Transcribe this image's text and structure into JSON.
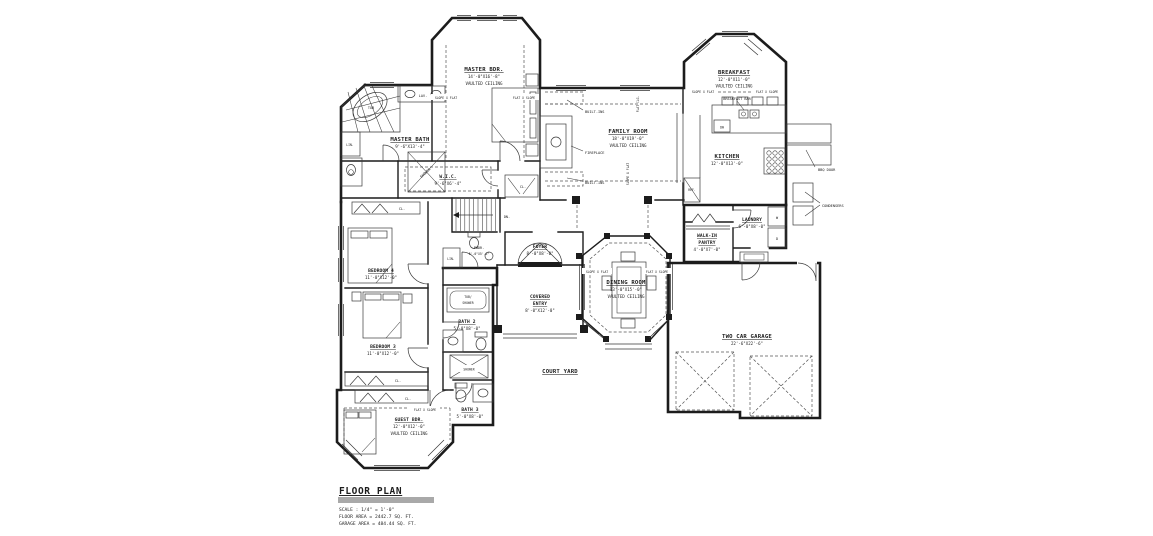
{
  "title_block": {
    "title": "FLOOR PLAN",
    "scale": "SCALE : 1/4\" = 1'-0\"",
    "floor_area": "FLOOR AREA = 2442.7 SQ. FT.",
    "garage_area": "GARAGE AREA = 484.44 SQ. FT."
  },
  "rooms": {
    "master_bdr": {
      "name": "MASTER BDR.",
      "dim": "14'-0\"X16'-8\"",
      "note": "VAULTED CEILING"
    },
    "master_bath": {
      "name": "MASTER BATH",
      "dim": "9'-6\"X13'-4\""
    },
    "wic": {
      "name": "W.I.C.",
      "dim": "9'-6\"X6'-4\""
    },
    "family_room": {
      "name": "FAMILY ROOM",
      "dim": "18'-0\"X19'-0\"",
      "note": "VAULTED CEILING"
    },
    "breakfast": {
      "name": "BREAKFAST",
      "dim": "12'-0\"X11'-0\"",
      "note": "VAULTED CEILING"
    },
    "kitchen": {
      "name": "KITCHEN",
      "dim": "12'-0\"X13'-0\""
    },
    "laundry": {
      "name": "LAUNDRY",
      "dim": "6'-0\"X8'-0\""
    },
    "pantry": {
      "name_line1": "WALK-IN",
      "name_line2": "PANTRY",
      "dim": "4'-0\"X7'-0\""
    },
    "dining_room": {
      "name": "DINING ROOM",
      "dim": "13'-0\"X15'-0\"",
      "note": "VAULTED CEILING"
    },
    "foyer": {
      "name": "FOYER",
      "dim": "8'-0\"X8'-0\""
    },
    "covered_entry": {
      "name_line1": "COVERED",
      "name_line2": "ENTRY",
      "dim": "8'-0\"X12'-0\""
    },
    "court_yard": {
      "name": "COURT YARD"
    },
    "garage": {
      "name": "TWO CAR GARAGE",
      "dim": "22'-6\"X22'-6\""
    },
    "bedroom4": {
      "name": "BEDROOM 4",
      "dim": "11'-0\"X12'-0\""
    },
    "bedroom3": {
      "name": "BEDROOM 3",
      "dim": "11'-0\"X12'-0\""
    },
    "guest_bdr": {
      "name": "GUEST BDR.",
      "dim": "12'-0\"X12'-0\"",
      "note": "VAULTED CEILING"
    },
    "bath2": {
      "name": "BATH 2",
      "dim": "5'-0\"X8'-0\""
    },
    "bath3": {
      "name": "BATH 3",
      "dim": "5'-0\"X8'-0\""
    },
    "pwdr": {
      "name": "PWDR.",
      "dim": "5'-0\"X5'-6\""
    }
  },
  "fixtures": {
    "tub": "TUB",
    "lav": "LAV.",
    "shower": "SHOWER",
    "lin": "LIN.",
    "cl": "CL.",
    "dn": "DN.",
    "fireplace": "FIREPLACE",
    "built_ins": "BUILT-INS",
    "breakfast_bar": "BREAKFAST BAR",
    "dw": "DW",
    "ref": "REF.",
    "washer": "W",
    "dryer": "D",
    "tub_shower_line1": "TUB/",
    "tub_shower_line2": "SHOWER",
    "bbq_door": "BBQ DOOR",
    "condensers": "CONDENSERS"
  },
  "ceiling_notes": {
    "slope_x_flat": "SLOPE X FLAT",
    "flat_x_slope": "FLAT X SLOPE",
    "flat_clg": "FLAT CLG."
  }
}
